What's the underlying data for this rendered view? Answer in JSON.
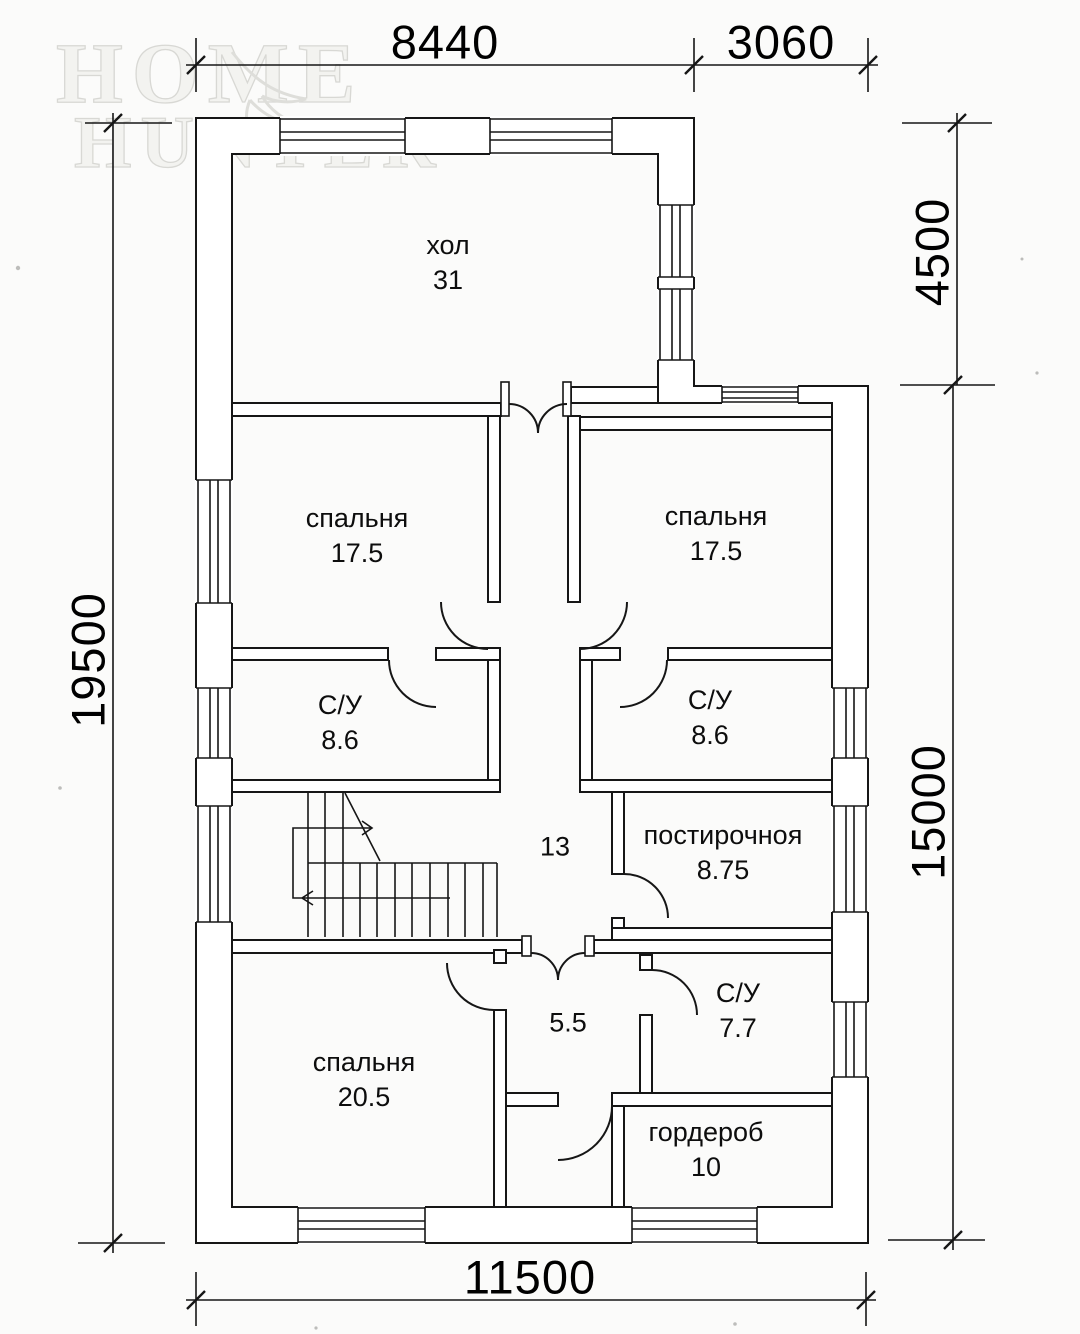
{
  "watermark": {
    "line1": "HOME",
    "line2": "HUNTER"
  },
  "dimensions": {
    "top_main": "8440",
    "top_right": "3060",
    "right_upper": "4500",
    "right_lower": "15000",
    "left": "19500",
    "bottom": "11500"
  },
  "rooms": {
    "hall": {
      "name": "хол",
      "area": "31"
    },
    "bedroom_top_left": {
      "name": "спальня",
      "area": "17.5"
    },
    "bedroom_top_right": {
      "name": "спальня",
      "area": "17.5"
    },
    "bathroom_left": {
      "name": "С/У",
      "area": "8.6"
    },
    "bathroom_right": {
      "name": "С/У",
      "area": "8.6"
    },
    "laundry": {
      "name": "постирочноя",
      "area": "8.75"
    },
    "corridor": {
      "area": "13"
    },
    "bedroom_bottom": {
      "name": "спальня",
      "area": "20.5"
    },
    "hall_bottom": {
      "area": "5.5"
    },
    "bathroom_bottom": {
      "name": "С/У",
      "area": "7.7"
    },
    "wardrobe": {
      "name": "гордероб",
      "area": "10"
    }
  }
}
